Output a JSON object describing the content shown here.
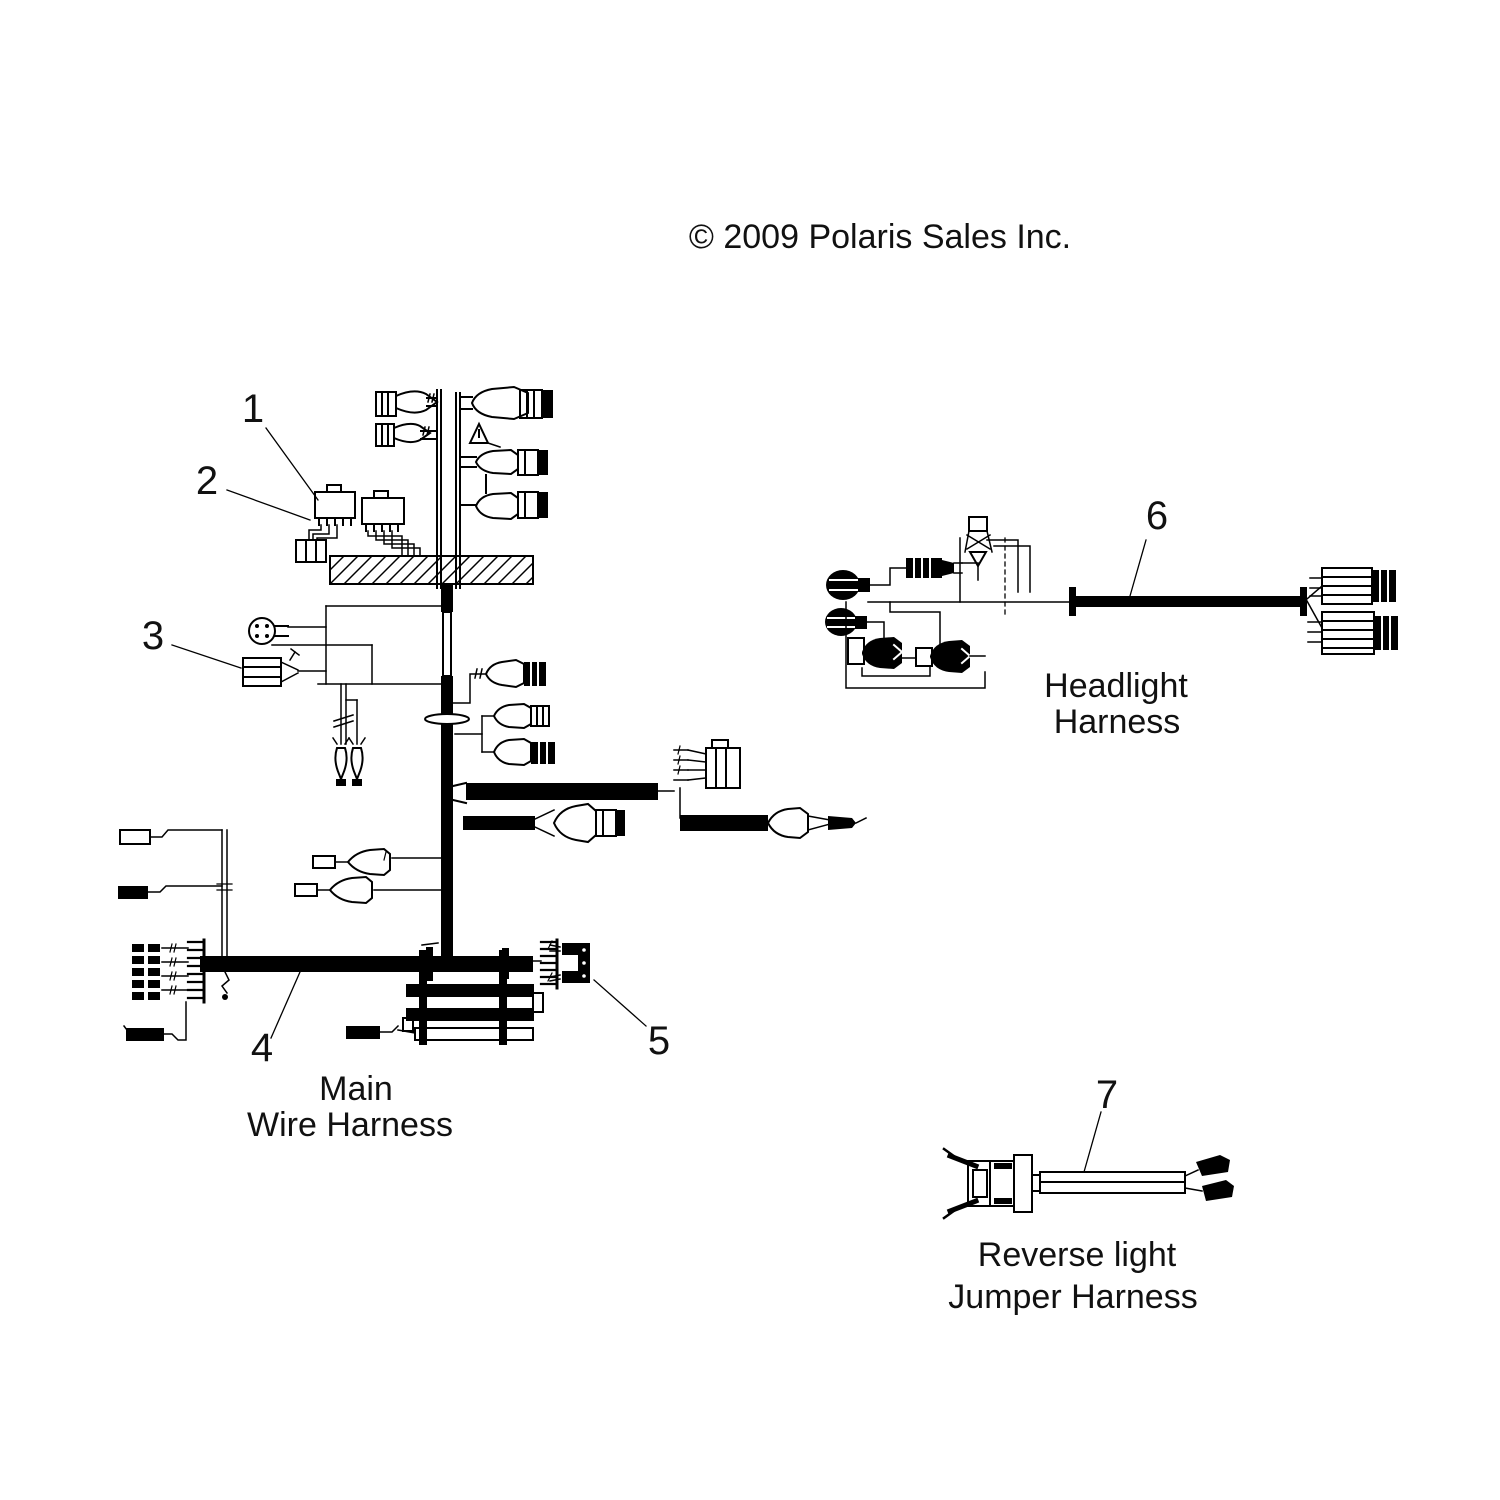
{
  "copyright": "© 2009 Polaris Sales Inc.",
  "main_harness": {
    "label_line1": "Main",
    "label_line2": "Wire Harness",
    "callout_1": "1",
    "callout_2": "2",
    "callout_3": "3",
    "callout_4": "4",
    "callout_5": "5"
  },
  "headlight_harness": {
    "label_line1": "Headlight",
    "label_line2": "Harness",
    "callout_6": "6"
  },
  "reverse_jumper_harness": {
    "label_line1": "Reverse light",
    "label_line2": "Jumper Harness",
    "callout_7": "7"
  }
}
